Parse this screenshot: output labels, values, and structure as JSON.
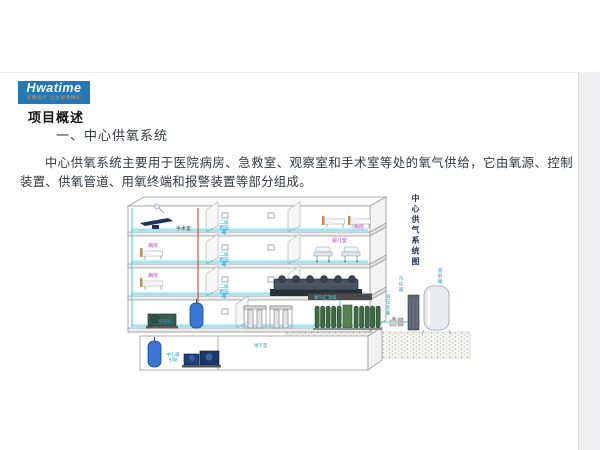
{
  "page": {
    "logo": {
      "brand": "Hwatime",
      "tagline": "华腾医疗  让生命更精彩"
    },
    "heading": "项目概述",
    "subheading": "一、中心供氧系统",
    "paragraph": "中心供氧系统主要用于医院病房、急救室、观察室和手术室等处的氧气供给，它由氧源、控制装置、供氧管道、用氧终端和报警装置等部分组成。"
  },
  "diagram": {
    "title_vertical": "中心供气系统图",
    "labels": {
      "operating_room": "手术室",
      "ward": "病房",
      "infant_room": "婴儿室",
      "stabilizer_box": "二级稳压箱",
      "oxygen_manifold": "氧气汇流排",
      "air_compressor": "空压机",
      "basement": "地下室",
      "suction_station": "中心吸引站",
      "pressure_reducer": "减压装置",
      "vaporizer": "汽化器",
      "lox_tank": "液氧罐"
    },
    "colors": {
      "brand_blue": "#2279b6",
      "tagline_orange": "#e78c2a",
      "pipe_cyan": "#46c8da",
      "pipe_red": "#cc3333",
      "label_cyan": "#1a9ec4",
      "label_magenta": "#cf3bbf",
      "title_navy": "#1f3864",
      "cylinder_green": "#3c6b42",
      "tank_blue": "#3a77d4"
    }
  }
}
